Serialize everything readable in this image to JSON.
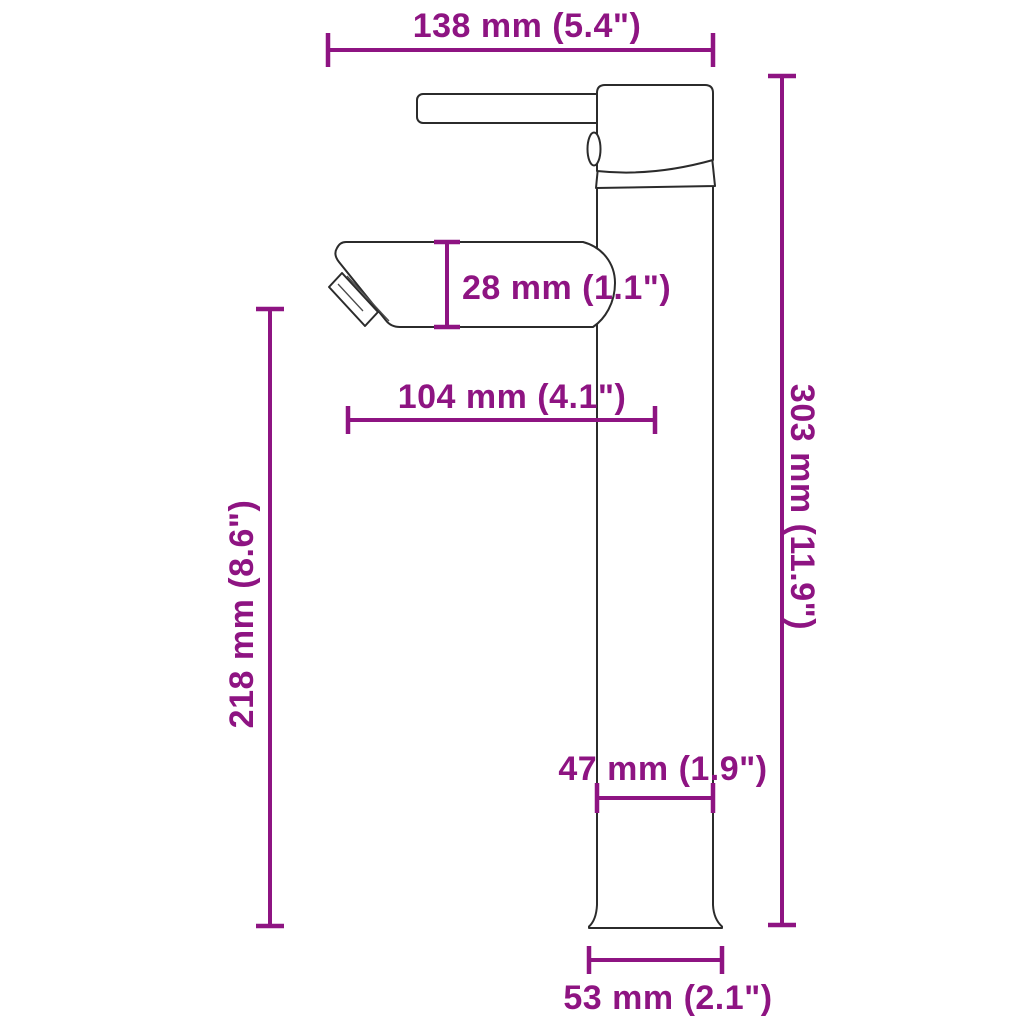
{
  "diagram": {
    "title": "Faucet dimension drawing",
    "subject": "tall single-lever vessel basin faucet, side profile view",
    "colors": {
      "dimension_annotations": "#8E1482",
      "product_outline": "#2b2b2b",
      "background": "#ffffff"
    },
    "dimensions": {
      "overall_depth": "138 mm (5.4\")",
      "spout_height": "28 mm (1.1\")",
      "spout_reach": "104 mm (4.1\")",
      "spout_clearance": "218 mm (8.6\")",
      "total_height": "303 mm (11.9\")",
      "body_width": "47 mm (1.9\")",
      "base_width": "53 mm (2.1\")"
    }
  }
}
